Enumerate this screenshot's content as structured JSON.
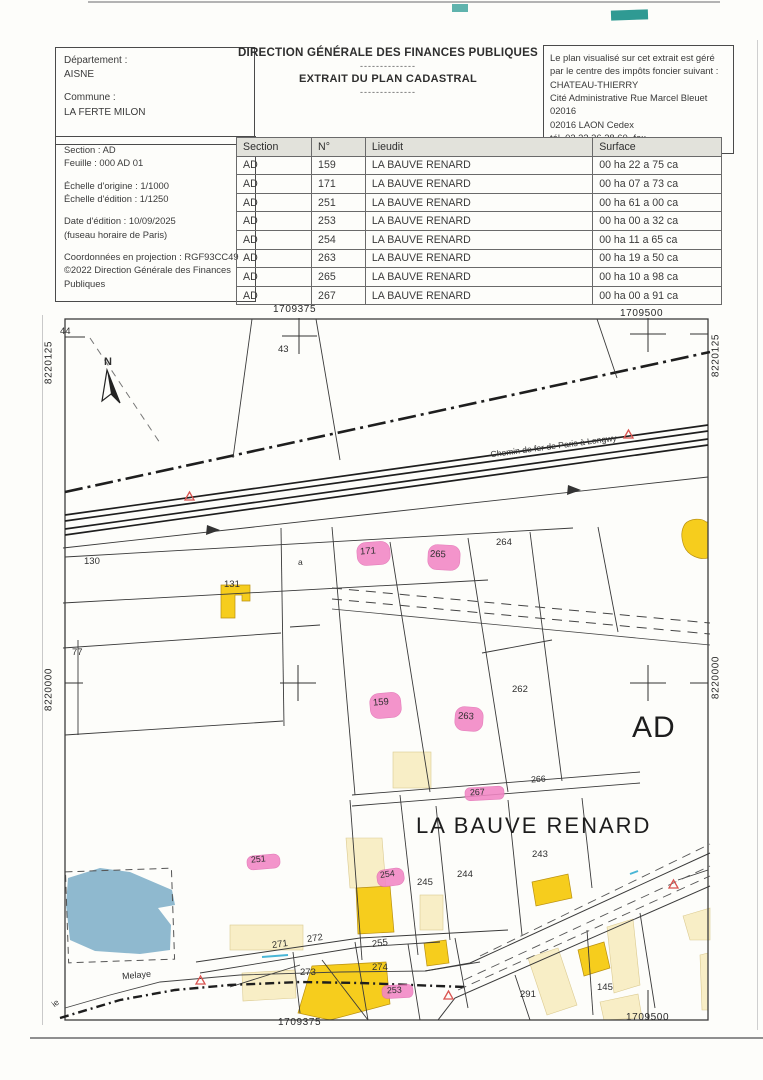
{
  "header": {
    "departement_label": "Département :",
    "departement": "AISNE",
    "commune_label": "Commune :",
    "commune": "LA FERTE MILON",
    "title1": "DIRECTION GÉNÉRALE DES FINANCES PUBLIQUES",
    "separator": "--------------",
    "title2": "EXTRAIT DU PLAN CADASTRAL",
    "notice_lines": [
      "Le plan visualisé sur cet extrait est géré",
      "par le centre des impôts foncier suivant :",
      "CHATEAU-THIERRY",
      "Cité Administrative Rue Marcel Bleuet",
      "02016",
      "02016 LAON Cedex",
      "tél. 03 23 26 28 60 -fax"
    ],
    "info_lines": {
      "section": "Section : AD",
      "feuille": "Feuille : 000 AD 01",
      "echelle_origine": "Échelle d'origine : 1/1000",
      "echelle_edition": "Échelle d'édition : 1/1250",
      "date_edition": "Date d'édition : 10/09/2025",
      "fuseau": "(fuseau horaire de Paris)",
      "projection": "Coordonnées en projection : RGF93CC49",
      "copyright1": "©2022 Direction Générale des Finances",
      "copyright2": "Publiques"
    }
  },
  "table": {
    "headers": [
      "Section",
      "N°",
      "Lieudit",
      "Surface"
    ],
    "rows": [
      [
        "AD",
        "159",
        "LA BAUVE RENARD",
        "00 ha 22 a 75 ca"
      ],
      [
        "AD",
        "171",
        "LA BAUVE RENARD",
        "00 ha 07 a 73 ca"
      ],
      [
        "AD",
        "251",
        "LA BAUVE RENARD",
        "00 ha 61 a 00 ca"
      ],
      [
        "AD",
        "253",
        "LA BAUVE RENARD",
        "00 ha 00 a 32 ca"
      ],
      [
        "AD",
        "254",
        "LA BAUVE RENARD",
        "00 ha 11 a 65 ca"
      ],
      [
        "AD",
        "263",
        "LA BAUVE RENARD",
        "00 ha 19 a 50 ca"
      ],
      [
        "AD",
        "265",
        "LA BAUVE RENARD",
        "00 ha 10 a 98 ca"
      ],
      [
        "AD",
        "267",
        "LA BAUVE RENARD",
        "00 ha 00 a 91 ca"
      ]
    ]
  },
  "map": {
    "coordinates": {
      "x_left": "1709375",
      "x_right": "1709500",
      "y_top": "8220125",
      "y_bottom": "8220000"
    },
    "section_label": "AD",
    "lieu_dit": "LA BAUVE RENARD",
    "railway": "Chemin de fer de Paris à Longwy",
    "road": "Melaye",
    "road_partial": "ie",
    "north": "N",
    "labels": {
      "44": "44",
      "43": "43",
      "130": "130",
      "131": "131",
      "a": "a",
      "77": "77",
      "171": "171",
      "265": "265",
      "264": "264",
      "159": "159",
      "263": "263",
      "262": "262",
      "266": "266",
      "267": "267",
      "243": "243",
      "244": "244",
      "245": "245",
      "251": "251",
      "254": "254",
      "255": "255",
      "271": "271",
      "272": "272",
      "273": "273",
      "274": "274",
      "253": "253",
      "291": "291",
      "145": "145"
    },
    "colors": {
      "building": "#f6cd1d",
      "light_building": "#f8eec6",
      "highlight_parcel": "#f286c4",
      "water": "#8fb9cf",
      "marker": "#d9534f"
    }
  }
}
